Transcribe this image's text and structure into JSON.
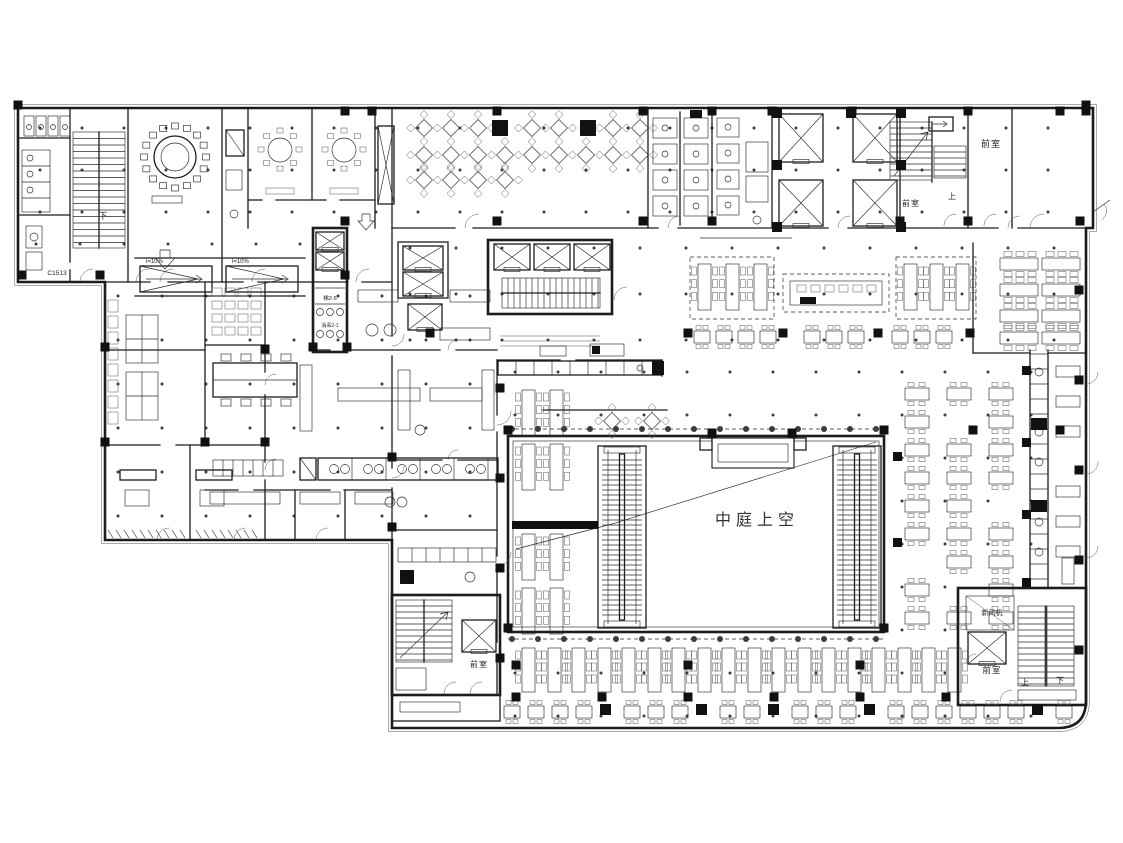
{
  "labels": {
    "atrium_void": "中庭上空",
    "anteroom": "前室",
    "fresh_air_unit": "新风机",
    "up": "上",
    "down": "下",
    "ramp_slope": "i=10%",
    "door_tag": "C1513",
    "lift_tag": "梯2-5",
    "disinfect_tag": "消毒2-1"
  },
  "colors": {
    "line": "#1c1c1c",
    "paper": "#ffffff",
    "dot": "#3c3c3c",
    "solid": "#111111"
  }
}
